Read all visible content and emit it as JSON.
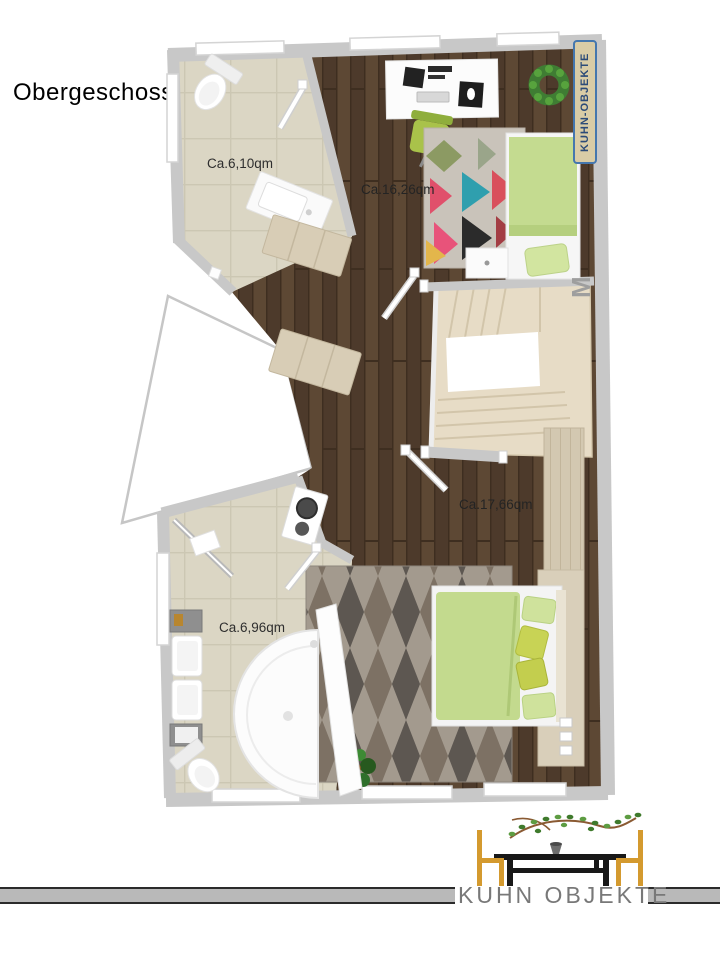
{
  "page": {
    "heading": "Obergeschoss:"
  },
  "floorplan": {
    "floor_name": "Obergeschoss",
    "rooms": [
      {
        "id": "bathroom-top",
        "type": "bathroom",
        "area_label": "Ca.6,10qm"
      },
      {
        "id": "bedroom-top",
        "type": "bedroom-office",
        "area_label": "Ca.16,26qm"
      },
      {
        "id": "bedroom-bottom",
        "type": "bedroom",
        "area_label": "Ca.17,66qm"
      },
      {
        "id": "bathroom-bottom",
        "type": "bathroom",
        "area_label": "Ca.6,96qm"
      }
    ],
    "features": [
      "staircase",
      "void-opening",
      "windows",
      "doors"
    ],
    "furniture": [
      "toilet",
      "sink-counter",
      "desk",
      "office-chair",
      "single-bed",
      "double-bed",
      "sideboard",
      "wardrobe",
      "double-sink-vanity",
      "corner-shower",
      "bathtub-panel",
      "rug-geometric",
      "rug-argyle",
      "wreath",
      "plant",
      "washer"
    ],
    "colors": {
      "wall": "#c8c8c8",
      "wood_floor": "#55412f",
      "tile_floor": "#dbd6c4",
      "stairs": "#e7dcc6",
      "bed_green": "#c3da8e",
      "accent_yellow_green": "#c8d355",
      "light_wood": "#d3c8b1"
    }
  },
  "watermark": {
    "badge_label": "KUHN-OBJEKTE",
    "badge_bg": "#d9cca6",
    "badge_border": "#4577ae",
    "partial_text": "M"
  },
  "logo": {
    "brand_text": "KUHN OBJEKTE",
    "chair_color": "#d49a2f",
    "table_color": "#181818",
    "bar_color": "#b9b9b9"
  }
}
